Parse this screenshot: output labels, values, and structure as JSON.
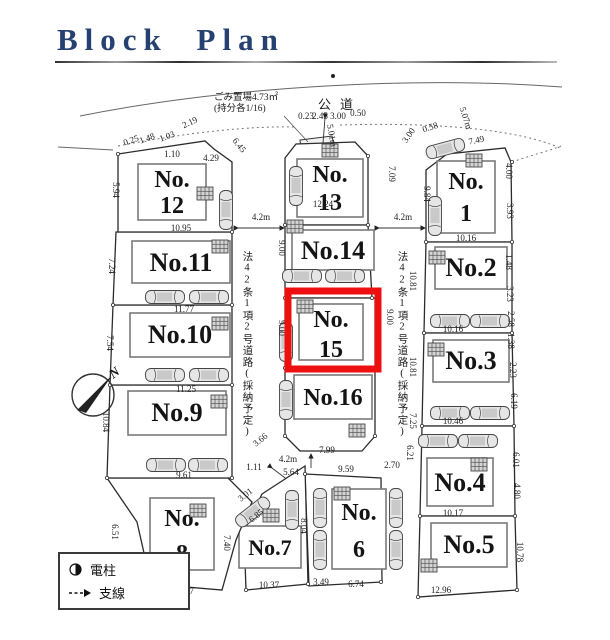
{
  "title": "Block Plan",
  "roads": {
    "public_road": "公道",
    "side_road": "法42条1項2号道路(採納予定)",
    "trash_line1": "ごみ置場4.73㎡",
    "trash_line2": "(持分各1/16)"
  },
  "compass": {
    "label": "N"
  },
  "legend": {
    "pole": "電柱",
    "wire": "支線"
  },
  "lots": {
    "1": {
      "l1": "No.",
      "l2": "1"
    },
    "2": {
      "l1": "No.2"
    },
    "3": {
      "l1": "No.3"
    },
    "4": {
      "l1": "No.4"
    },
    "5": {
      "l1": "No.5"
    },
    "6": {
      "l1": "No.",
      "l2": "6"
    },
    "7": {
      "l1": "No.7"
    },
    "8": {
      "l1": "No.",
      "l2": "8"
    },
    "9": {
      "l1": "No.9"
    },
    "10": {
      "l1": "No.10"
    },
    "11": {
      "l1": "No.11"
    },
    "12": {
      "l1": "No.",
      "l2": "12"
    },
    "13": {
      "l1": "No.",
      "l2": "13"
    },
    "14": {
      "l1": "No.14"
    },
    "15": {
      "l1": "No.",
      "l2": "15"
    },
    "16": {
      "l1": "No.16"
    }
  },
  "highlight_color": "#ee1010",
  "title_color": "#26406f",
  "dims": [
    "5.01m",
    "2.19",
    "0.25",
    "1.48",
    "1.03",
    "1.10",
    "4.29",
    "6.45",
    "0.23",
    "2.45",
    "3.00",
    "0.50",
    "3.00",
    "0.58",
    "5.07m",
    "7.49",
    "7.09",
    "9.84",
    "4.00",
    "3.93",
    "10.16",
    "4.2m",
    "4.2m",
    "9.00",
    "9.00",
    "10.81",
    "9.00",
    "10.81",
    "7.25",
    "10.16",
    "10.46",
    "10.17",
    "12.96",
    "6.21",
    "2.70",
    "9.59",
    "7.99",
    "4.2m",
    "5.64",
    "1.11",
    "9.61",
    "8.07",
    "10.37",
    "3.49",
    "6.74",
    "7.40",
    "3.01",
    "6.85",
    "3.66",
    "10.95",
    "11.77",
    "11.25",
    "12.24",
    "1.48",
    "3.23",
    "2.58",
    "1.38",
    "2.23",
    "6.19",
    "6.01",
    "4.80",
    "10.78",
    "8.04",
    "5.94",
    "7.24",
    "7.54",
    "10.84",
    "6.51"
  ]
}
